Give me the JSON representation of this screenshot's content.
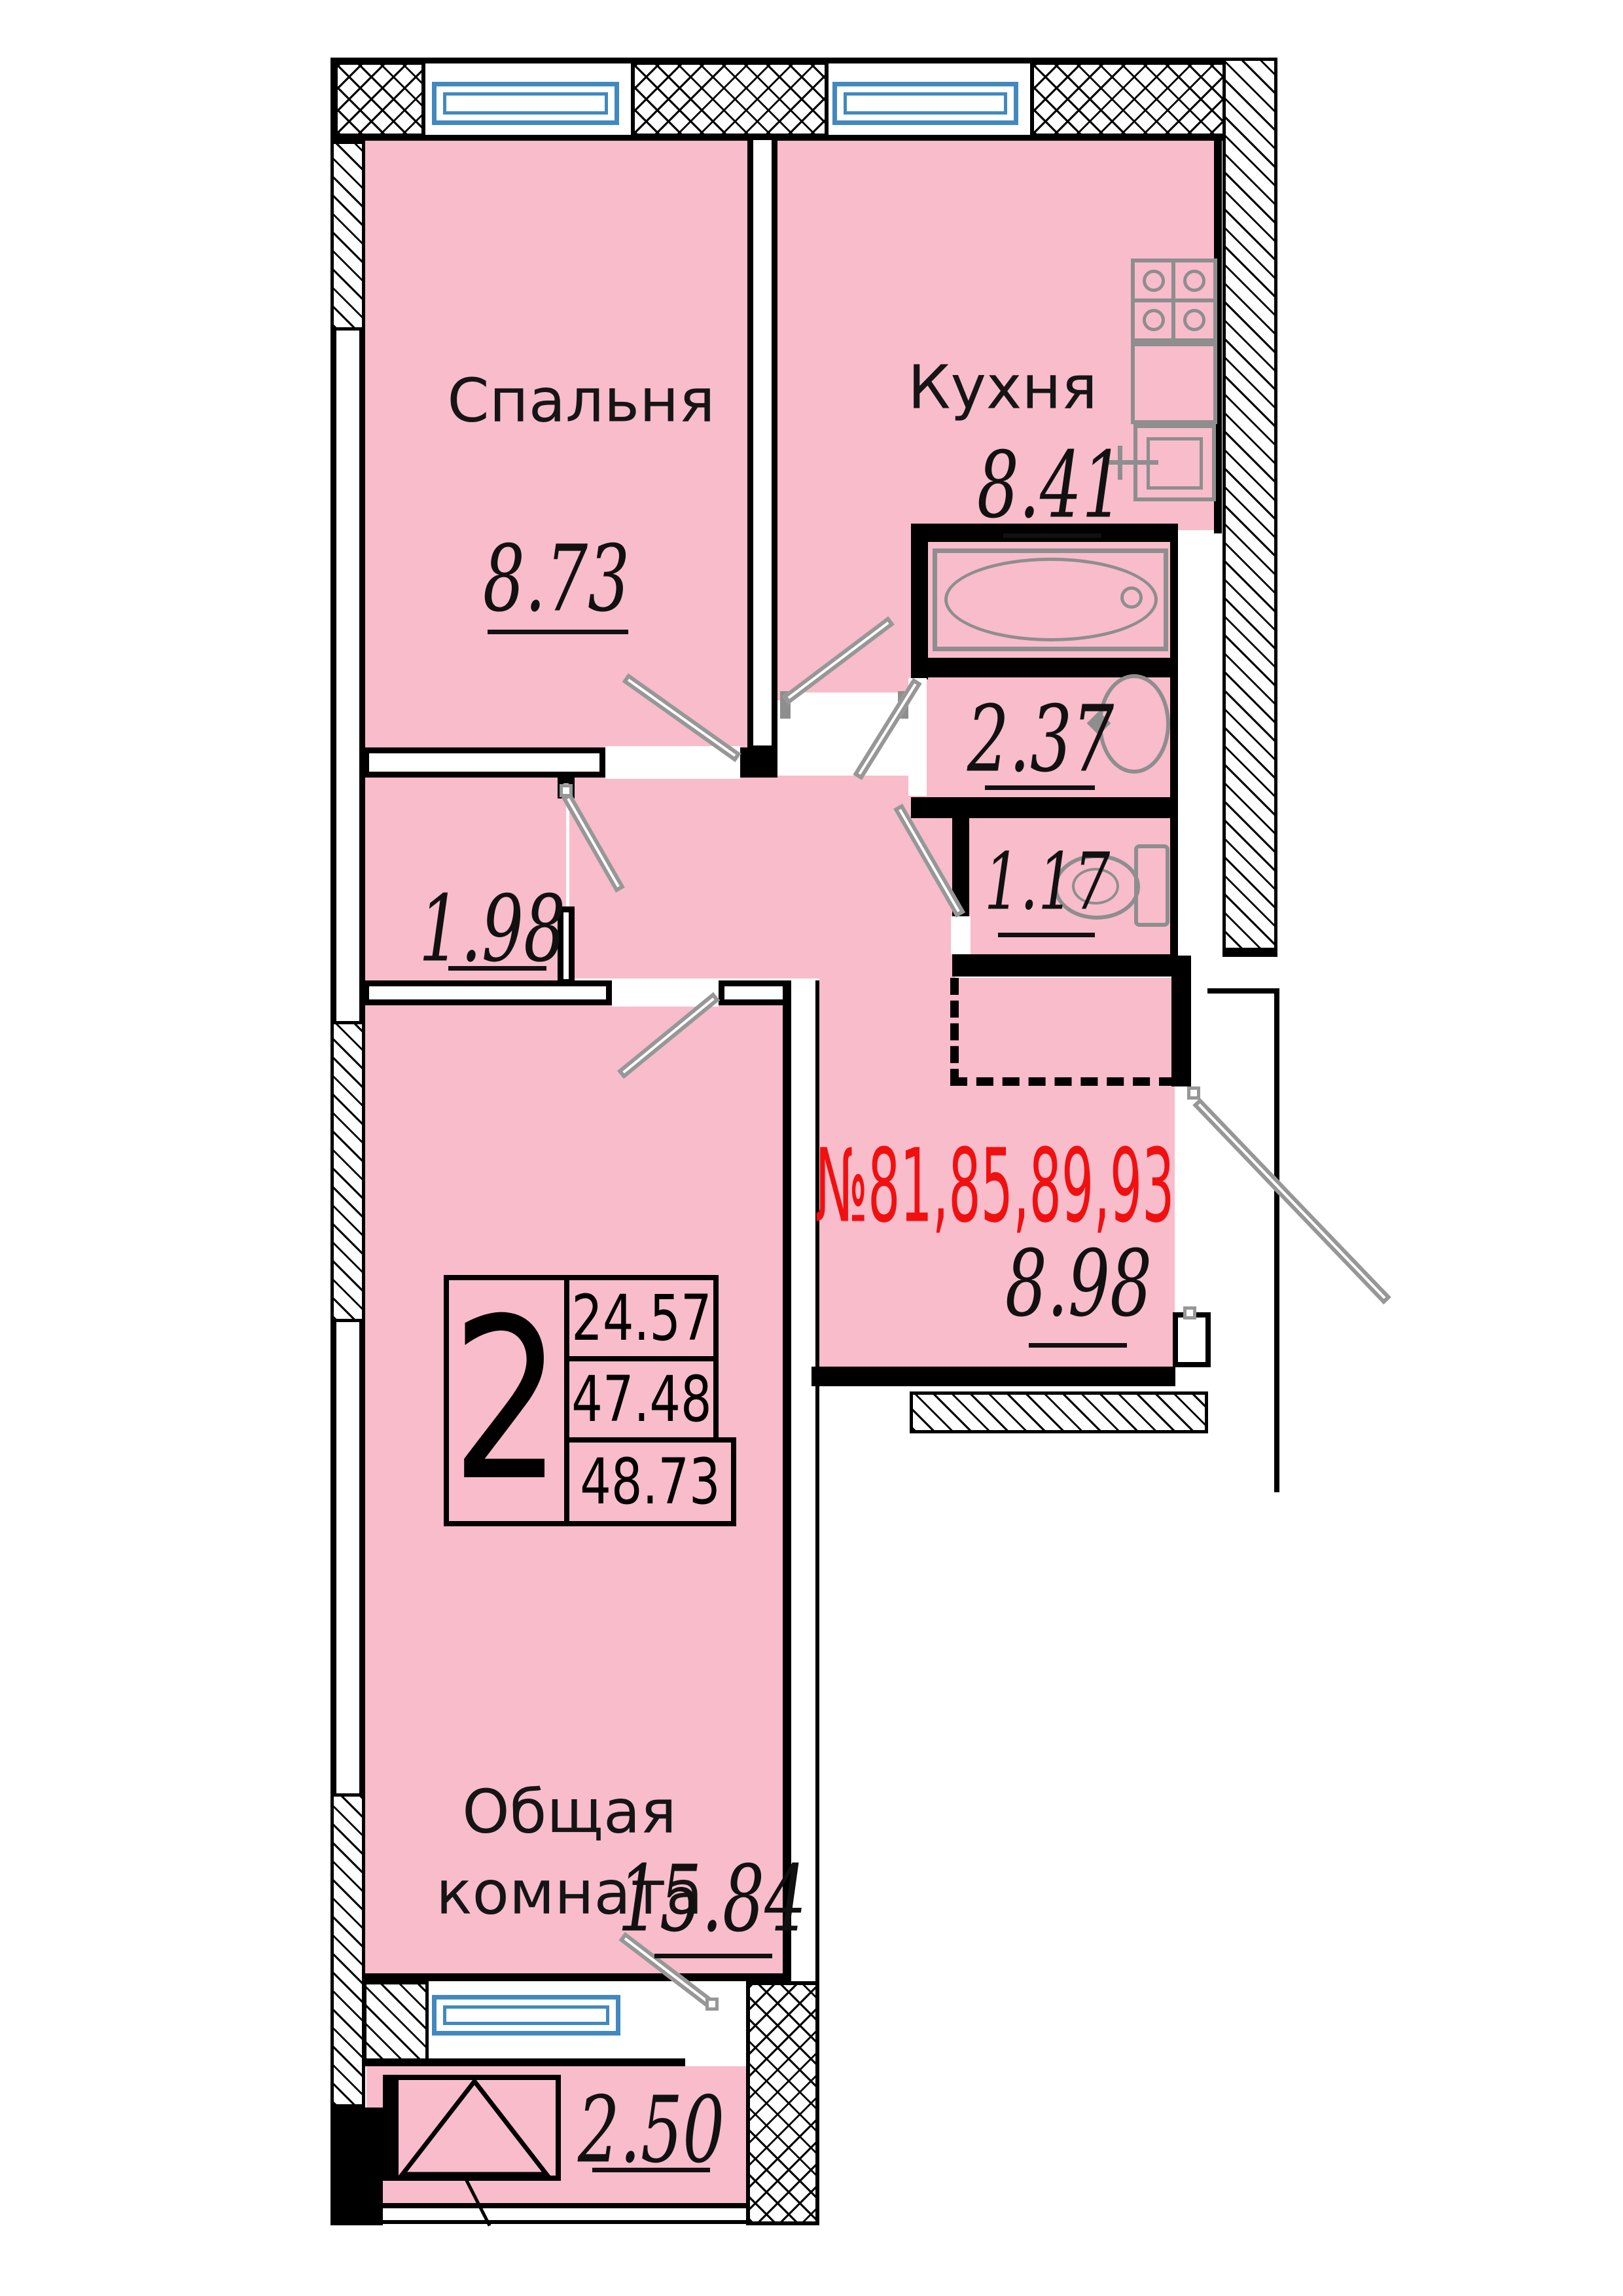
{
  "badge": {
    "rooms": "2",
    "living_area": "24.57",
    "apartment_area": "47.48",
    "total_area": "48.73"
  },
  "apartment_numbers": "№81,85,89,93",
  "rooms": {
    "bedroom": {
      "label": "Спальня",
      "area": "8.73"
    },
    "kitchen": {
      "label": "Кухня",
      "area": "8.41"
    },
    "bathroom": {
      "area": "2.37"
    },
    "toilet": {
      "area": "1.17"
    },
    "closet": {
      "area": "1.98"
    },
    "hall": {
      "area": "8.98"
    },
    "living": {
      "label_line1": "Общая",
      "label_line2": "комната",
      "area": "15.84"
    },
    "balcony": {
      "area": "2.50"
    }
  },
  "colors": {
    "room_fill": "#f8bccb",
    "apartment_number_red": "#f01010",
    "window_blue": "#4189bf",
    "fixture_gray": "#8e8e8e"
  }
}
